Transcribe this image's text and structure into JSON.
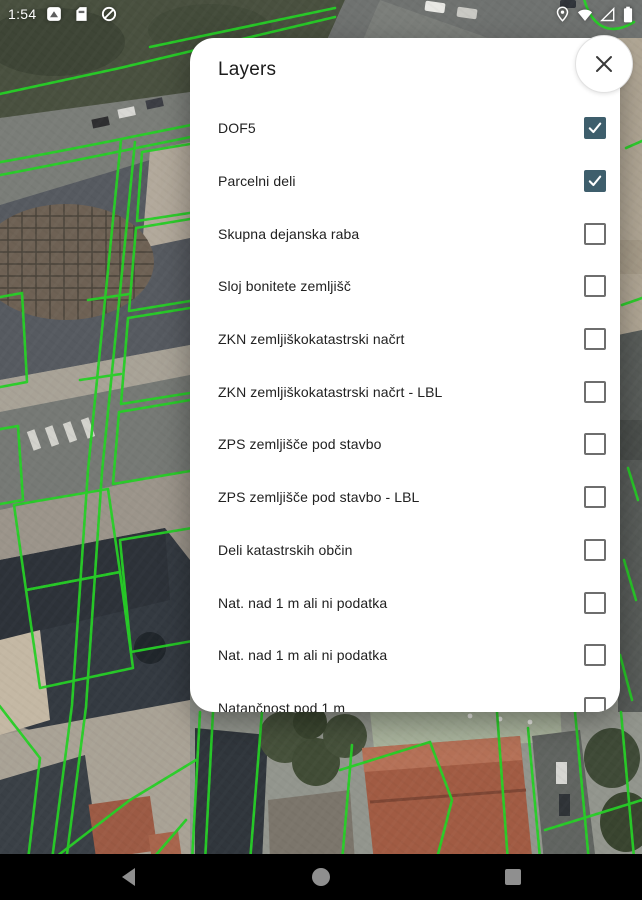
{
  "status_bar": {
    "time": "1:54",
    "left_icons": [
      "screenshot-icon",
      "sim-card-icon",
      "data-saver-icon"
    ],
    "right_icons": [
      "location-icon",
      "wifi-icon",
      "cell-signal-empty-icon",
      "battery-icon"
    ]
  },
  "dialog": {
    "title": "Layers",
    "close_icon": "close-icon",
    "checked_color": "#3e5e6c",
    "layers": [
      {
        "label": "DOF5",
        "checked": true
      },
      {
        "label": "Parcelni deli",
        "checked": true
      },
      {
        "label": "Skupna dejanska raba",
        "checked": false
      },
      {
        "label": "Sloj bonitete zemljišč",
        "checked": false
      },
      {
        "label": "ZKN zemljiškokatastrski načrt",
        "checked": false
      },
      {
        "label": "ZKN zemljiškokatastrski načrt - LBL",
        "checked": false
      },
      {
        "label": "ZPS zemljišče pod stavbo",
        "checked": false
      },
      {
        "label": "ZPS zemljišče pod stavbo - LBL",
        "checked": false
      },
      {
        "label": "Deli katastrskih občin",
        "checked": false
      },
      {
        "label": "Nat. nad 1 m ali ni podatka",
        "checked": false
      },
      {
        "label": "Nat. nad 1 m ali ni podatka",
        "checked": false
      },
      {
        "label": "Natančnost pod 1 m",
        "checked": false
      }
    ]
  },
  "map": {
    "type": "aerial-orthophoto-with-cadastral-overlay",
    "parcel_line_color": "#26d026"
  },
  "nav_bar": {
    "icons": [
      "back-icon",
      "home-icon",
      "recents-icon"
    ]
  }
}
